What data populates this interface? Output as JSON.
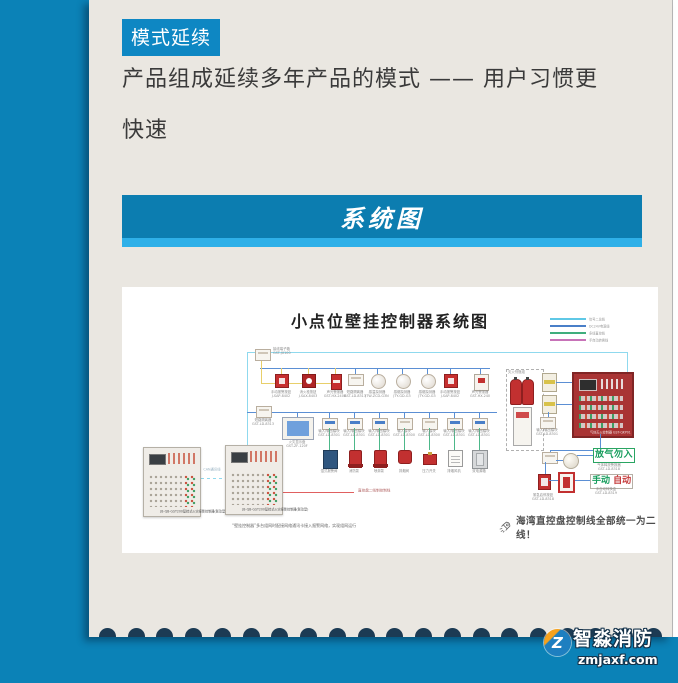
{
  "theme": {
    "blue": "#0b82b7",
    "light_blue": "#2fb0e8",
    "navy": "#1c3b54",
    "card": "#eae7e1",
    "banner": "#0c7db0",
    "tag": "#0e87c3",
    "text": "#3a3a3a"
  },
  "header": {
    "tag": "模式延续",
    "line1": "产品组成延续多年产品的模式 —— 用户习惯更",
    "line2": "快速"
  },
  "banner": {
    "title": "系统图"
  },
  "diagram": {
    "title": "小点位壁挂控制器系统图",
    "legend": [
      {
        "color": "#5fc8e6",
        "label": "信号二总线"
      },
      {
        "color": "#4a7fc8",
        "label": "DC24V电源线"
      },
      {
        "color": "#3fae7d",
        "label": "多线直控线"
      },
      {
        "color": "#c873b8",
        "label": "手自动转换线"
      }
    ],
    "junction_box": {
      "name": "接线端子箱",
      "model": "GST-JX100"
    },
    "row1": [
      {
        "type": "manual",
        "name": "手动报警按钮",
        "model": "J-SAP-8402"
      },
      {
        "type": "hydrant",
        "name": "消火栓按钮",
        "model": "J-SAX-8403"
      },
      {
        "type": "sounder",
        "name": "声光警报器",
        "model": "GST-HX-240B"
      },
      {
        "type": "module",
        "name": "短路隔离器",
        "model": "GST-LD-8313"
      },
      {
        "type": "round",
        "name": "感温探测器",
        "model": "JTW-ZCD-G3N"
      },
      {
        "type": "round",
        "name": "感烟探测器",
        "model": "JTY-GD-G3"
      },
      {
        "type": "round",
        "name": "感烟探测器",
        "model": "JTY-GD-G3"
      },
      {
        "type": "manual",
        "name": "手动报警按钮",
        "model": "J-SAP-8402"
      },
      {
        "type": "strobe",
        "name": "声光警报器",
        "model": "GST-HX-240"
      }
    ],
    "isolator": {
      "name": "短路隔离器",
      "model": "GST-LD-8313"
    },
    "display": {
      "name": "火灾显示盘",
      "model": "GST-ZF-120F"
    },
    "row2": [
      {
        "module": {
          "name": "输入/输出模块",
          "model": "GST-LD-8301"
        },
        "equip": {
          "type": "tank",
          "name": "湿式报警阀"
        }
      },
      {
        "module": {
          "name": "输入/输出模块",
          "model": "GST-LD-8301"
        },
        "equip": {
          "type": "pump",
          "name": "消防泵"
        }
      },
      {
        "module": {
          "name": "输入/输出模块",
          "model": "GST-LD-8301"
        },
        "equip": {
          "type": "pump",
          "name": "喷淋泵"
        }
      },
      {
        "module": {
          "name": "输入模块",
          "model": "GST-LD-8300"
        },
        "equip": {
          "type": "valve",
          "name": "排烟阀"
        }
      },
      {
        "module": {
          "name": "输入模块",
          "model": "GST-LD-8300"
        },
        "equip": {
          "type": "press",
          "name": "压力开关"
        }
      },
      {
        "module": {
          "name": "输入/输出模块",
          "model": "GST-LD-8301"
        },
        "equip": {
          "type": "fanbox",
          "name": "排烟风机"
        }
      },
      {
        "module": {
          "name": "输入/输出模块",
          "model": "GST-LD-8301"
        },
        "equip": {
          "type": "graycab",
          "name": "双电源箱"
        }
      }
    ],
    "panels": {
      "label": "JB-QB-GST200壁挂式火灾报警控制器(联动型)",
      "link_label": "CAN通讯线",
      "caption": "“壁挂控制器”多台组网时配接网络通讯卡接入报警网络，实现组网运行",
      "direct_line_label": "直控盘二线制控制线"
    },
    "right": {
      "cylinders_label": "灭火剂瓶组",
      "detector1": {
        "name": "感烟探测器"
      },
      "detector2": {
        "name": "感温探测器"
      },
      "module_top": {
        "name": "输入/输出模块",
        "model": "GST-LD-8301"
      },
      "gas_panel_label": "气体灭火控制器 GST-QKP01",
      "module_mid": {
        "name": "输入/输出模块",
        "model": "GST-LD-8301"
      },
      "sign_no_entry": "放气勿入",
      "release_label": {
        "name": "气体释放警报器",
        "model": "GST-LD-8318"
      },
      "emergency": {
        "name": "紧急启停按钮",
        "model": "GST-LD-8318"
      },
      "indicator": {
        "name": "放气指示灯"
      },
      "sign_manual": "手动",
      "sign_auto": "自动",
      "switch_label": {
        "name": "手自动转换盒",
        "model": "GST-LD-8319"
      }
    },
    "slogan": "海湾直控盘控制线全部统一为二线！"
  },
  "footer": {
    "brand": "智淼消防",
    "site": "zmjaxf.com"
  }
}
